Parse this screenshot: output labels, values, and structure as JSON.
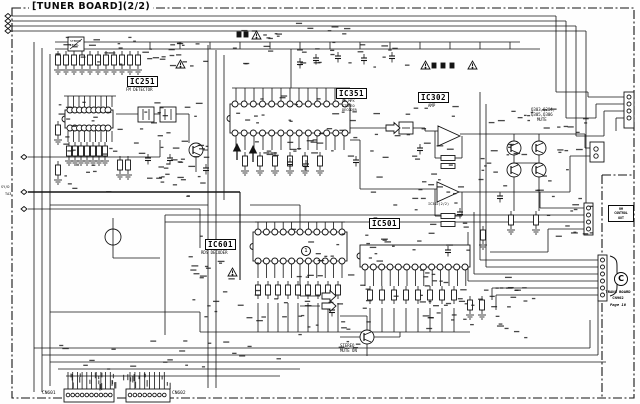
{
  "title": "[TUNER BOARD](2/2)",
  "ics": {
    "ic251": {
      "id": "IC251",
      "sub": "FM DETECTOR"
    },
    "ic351": {
      "id": "IC351",
      "sub1": "FM MPX",
      "sub2": "STEREO",
      "sub3": "DECODER"
    },
    "ic302": {
      "id": "IC302",
      "sub": "AMP",
      "half2": "IC302(2/2)"
    },
    "ic601": {
      "id": "IC601",
      "sub": "RDS DECODER"
    },
    "ic501": {
      "id": "IC501"
    }
  },
  "annotations": {
    "mute1": "Q303,Q304,",
    "mute2": "Q305,Q306",
    "mute3": "MUTE",
    "smute1": "STEREO",
    "smute2": "MUTE ON",
    "trim1": "STEREO",
    "trim2": "LEVEL",
    "edge1": "SY/D",
    "edge2": "TA3",
    "pin1": "1"
  },
  "control_box": {
    "l1": "RM",
    "l2": "CONTROL",
    "l3": "OUT"
  },
  "offpage": {
    "letter": "C",
    "l1": "TRANS BOARD",
    "l2": "CN902",
    "l3": "Page 10"
  },
  "connectors": {
    "left": "CN601",
    "right": "CN602"
  }
}
